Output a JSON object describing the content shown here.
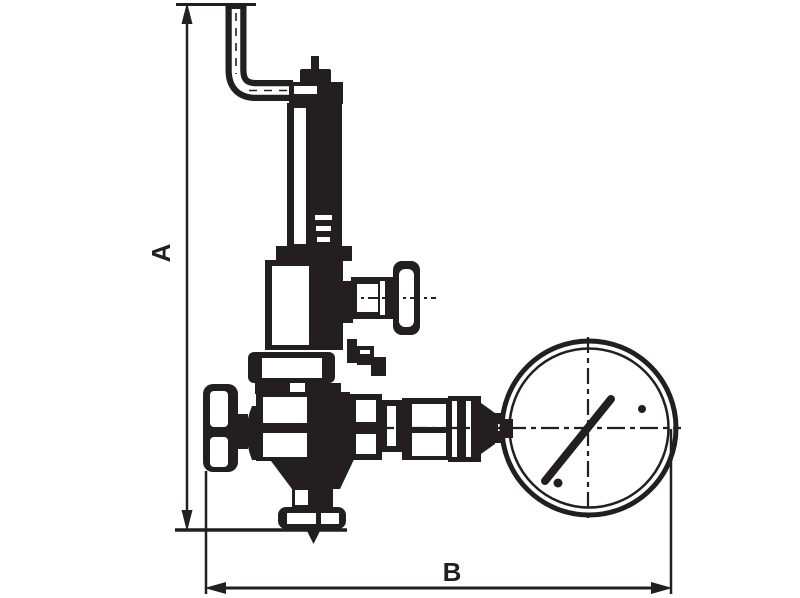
{
  "diagram": {
    "type": "technical-dimension-drawing",
    "subject": "pressure-reducing-valve-with-gauge",
    "labels": {
      "height_dimension": "A",
      "width_dimension": "B"
    },
    "colors": {
      "ink": "#231f20",
      "background": "#ffffff"
    }
  }
}
